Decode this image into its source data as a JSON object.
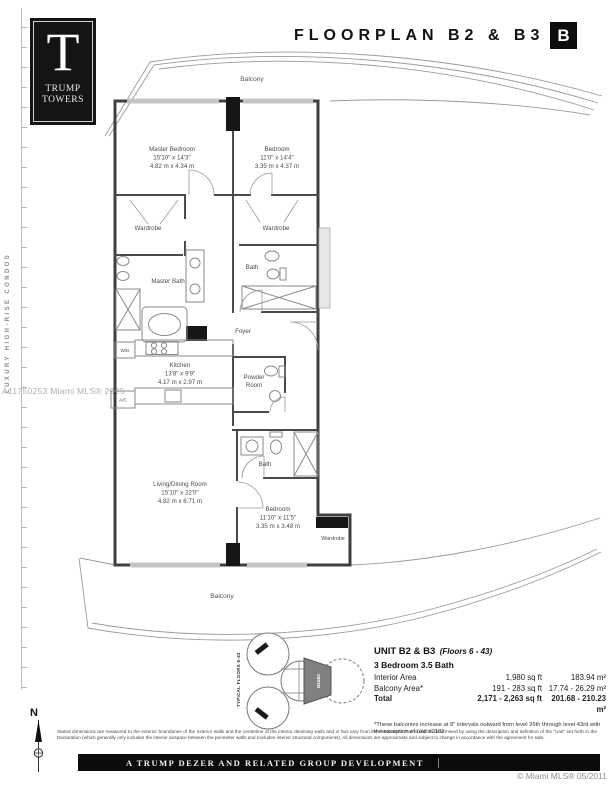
{
  "header": {
    "title": "FLOORPLAN B2 & B3",
    "badge": "B"
  },
  "logo": {
    "initial": "T",
    "name_line1": "TRUMP",
    "name_line2": "TOWERS"
  },
  "side": {
    "vertical_label": "LUXURY HIGH-RISE CONDOS",
    "watermark": "A11750253 Miami MLS® 2025"
  },
  "plan": {
    "balcony_top": "Balcony",
    "balcony_bottom": "Balcony",
    "master_bedroom": {
      "name": "Master Bedroom",
      "ft": "15'10\" x 14'3\"",
      "m": "4.82 m x 4.34 m"
    },
    "bedroom_top": {
      "name": "Bedroom",
      "ft": "11'0\" x 14'4\"",
      "m": "3.35 m x 4.37 m"
    },
    "wardrobe_master": "Wardrobe",
    "wardrobe_top": "Wardrobe",
    "master_bath": "Master Bath",
    "bath_top": "Bath",
    "foyer": "Foyer",
    "kitchen": {
      "name": "Kitchen",
      "ft": "13'8\" x 9'9\"",
      "m": "4.17 m x 2.97 m"
    },
    "wd": "W/D",
    "ac": "A/C",
    "powder_line1": "Powder",
    "powder_line2": "Room",
    "living": {
      "name": "Living/Dining Room",
      "ft": "15'10\" x 22'0\"",
      "m": "4.82 m x 6.71 m"
    },
    "bath_bottom": "Bath",
    "bedroom_bottom": {
      "name": "Bedroom",
      "ft": "11'10\" x 11'5\"",
      "m": "3.35 m x 3.48 m"
    },
    "wardrobe_bottom": "Wardrobe"
  },
  "keyplan": {
    "side_label": "TYPICAL FLOORS 6-43",
    "unit_label": "B2&B3"
  },
  "north_label": "N",
  "unit_info": {
    "title": "UNIT B2 & B3",
    "floors": "(Floors 6 - 43)",
    "subtitle": "3 Bedroom 3.5 Bath",
    "rows": [
      {
        "label": "Interior Area",
        "sqft": "1,980 sq ft",
        "sqm": "183.94 m²"
      },
      {
        "label": "Balcony Area*",
        "sqft": "191 - 283 sq ft",
        "sqm": "17.74 - 26.29 m²"
      },
      {
        "label": "Total",
        "sqft": "2,171 - 2,263 sq ft",
        "sqm": "201.68 - 210.23 m²"
      }
    ],
    "footnote": "*These balconies increase at 8\" intervals outward from level 26th through level 43rd with the exception of Unit #2102"
  },
  "footer": {
    "disclaimer": "Stated dimensions are measured to the exterior boundaries of the exterior walls and the centerline of the interior demising walls and in fact vary from the dimensions that would be determined by using the description and definition of the \"Unit\" set forth in the Declaration (which generally only includes the interior airspace between the perimeter walls and excludes interior structural components). All dimensions are approximate and subject to change in accordance with the agreement for sale.",
    "development": "A TRUMP DEZER AND RELATED GROUP DEVELOPMENT",
    "copyright": "© Miami MLS® 05/2011"
  },
  "colors": {
    "accent_black": "#0d0d0d",
    "wall": "#3f3f3f",
    "label": "#4a4a4a",
    "glazing": "#c4c4c4"
  }
}
